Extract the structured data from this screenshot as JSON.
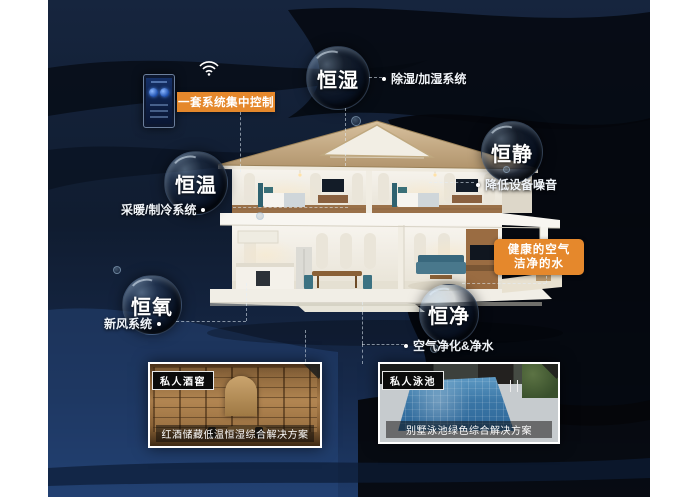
{
  "colors": {
    "accent_orange": "#e5882c",
    "background_navy": "#131f33",
    "wave_black": "#05080e",
    "bottom_blue": "#274a7e",
    "bubble_text": "#ffffff"
  },
  "control_panel": {
    "device_icon": "smart-home-controller",
    "wifi_icon": "wifi-icon",
    "label": "一套系统集中控制"
  },
  "bubbles": [
    {
      "id": "humidity",
      "label": "恒湿",
      "feature": "除湿/加湿系统"
    },
    {
      "id": "quiet",
      "label": "恒静",
      "feature": "降低设备噪音"
    },
    {
      "id": "temperature",
      "label": "恒温",
      "feature": "采暖/制冷系统"
    },
    {
      "id": "oxygen",
      "label": "恒氧",
      "feature": "新风系统"
    },
    {
      "id": "purity",
      "label": "恒净",
      "feature": "空气净化&净水"
    }
  ],
  "highlight_box": {
    "line1": "健康的空气",
    "line2": "洁净的水"
  },
  "cases": [
    {
      "tag": "私人酒窖",
      "caption": "红酒储藏低温恒湿综合解决方案"
    },
    {
      "tag": "私人泳池",
      "caption": "别墅泳池绿色综合解决方案"
    }
  ]
}
